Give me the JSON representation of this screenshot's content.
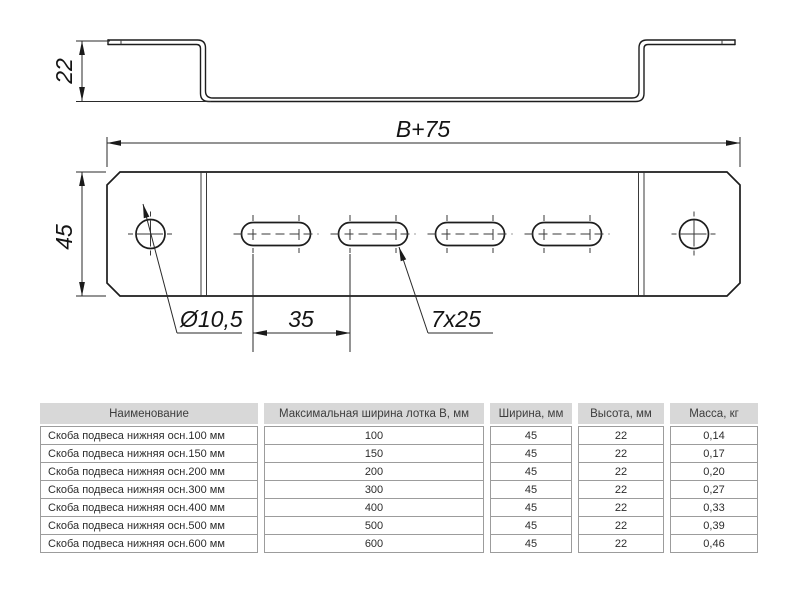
{
  "drawing": {
    "dims": {
      "profile_height": "22",
      "overall_width": "B+75",
      "plate_height": "45",
      "hole_diameter": "Ø10,5",
      "slot_pitch": "35",
      "slot_size": "7x25"
    },
    "line_color": "#1d1d1d"
  },
  "table": {
    "header_bg": "#d8d8d8",
    "columns": [
      {
        "label": "Наименование",
        "width": 218,
        "align": "left"
      },
      {
        "label": "Максимальная ширина лотка B, мм",
        "width": 220,
        "align": "center"
      },
      {
        "label": "Ширина, мм",
        "width": 82,
        "align": "center"
      },
      {
        "label": "Высота, мм",
        "width": 86,
        "align": "center"
      },
      {
        "label": "Масса, кг",
        "width": 88,
        "align": "center"
      }
    ],
    "rows": [
      [
        "Скоба подвеса нижняя осн.100 мм",
        "100",
        "45",
        "22",
        "0,14"
      ],
      [
        "Скоба подвеса нижняя осн.150 мм",
        "150",
        "45",
        "22",
        "0,17"
      ],
      [
        "Скоба подвеса нижняя осн.200 мм",
        "200",
        "45",
        "22",
        "0,20"
      ],
      [
        "Скоба подвеса нижняя осн.300 мм",
        "300",
        "45",
        "22",
        "0,27"
      ],
      [
        "Скоба подвеса нижняя осн.400 мм",
        "400",
        "45",
        "22",
        "0,33"
      ],
      [
        "Скоба подвеса нижняя осн.500 мм",
        "500",
        "45",
        "22",
        "0,39"
      ],
      [
        "Скоба подвеса нижняя осн.600 мм",
        "600",
        "45",
        "22",
        "0,46"
      ]
    ]
  }
}
